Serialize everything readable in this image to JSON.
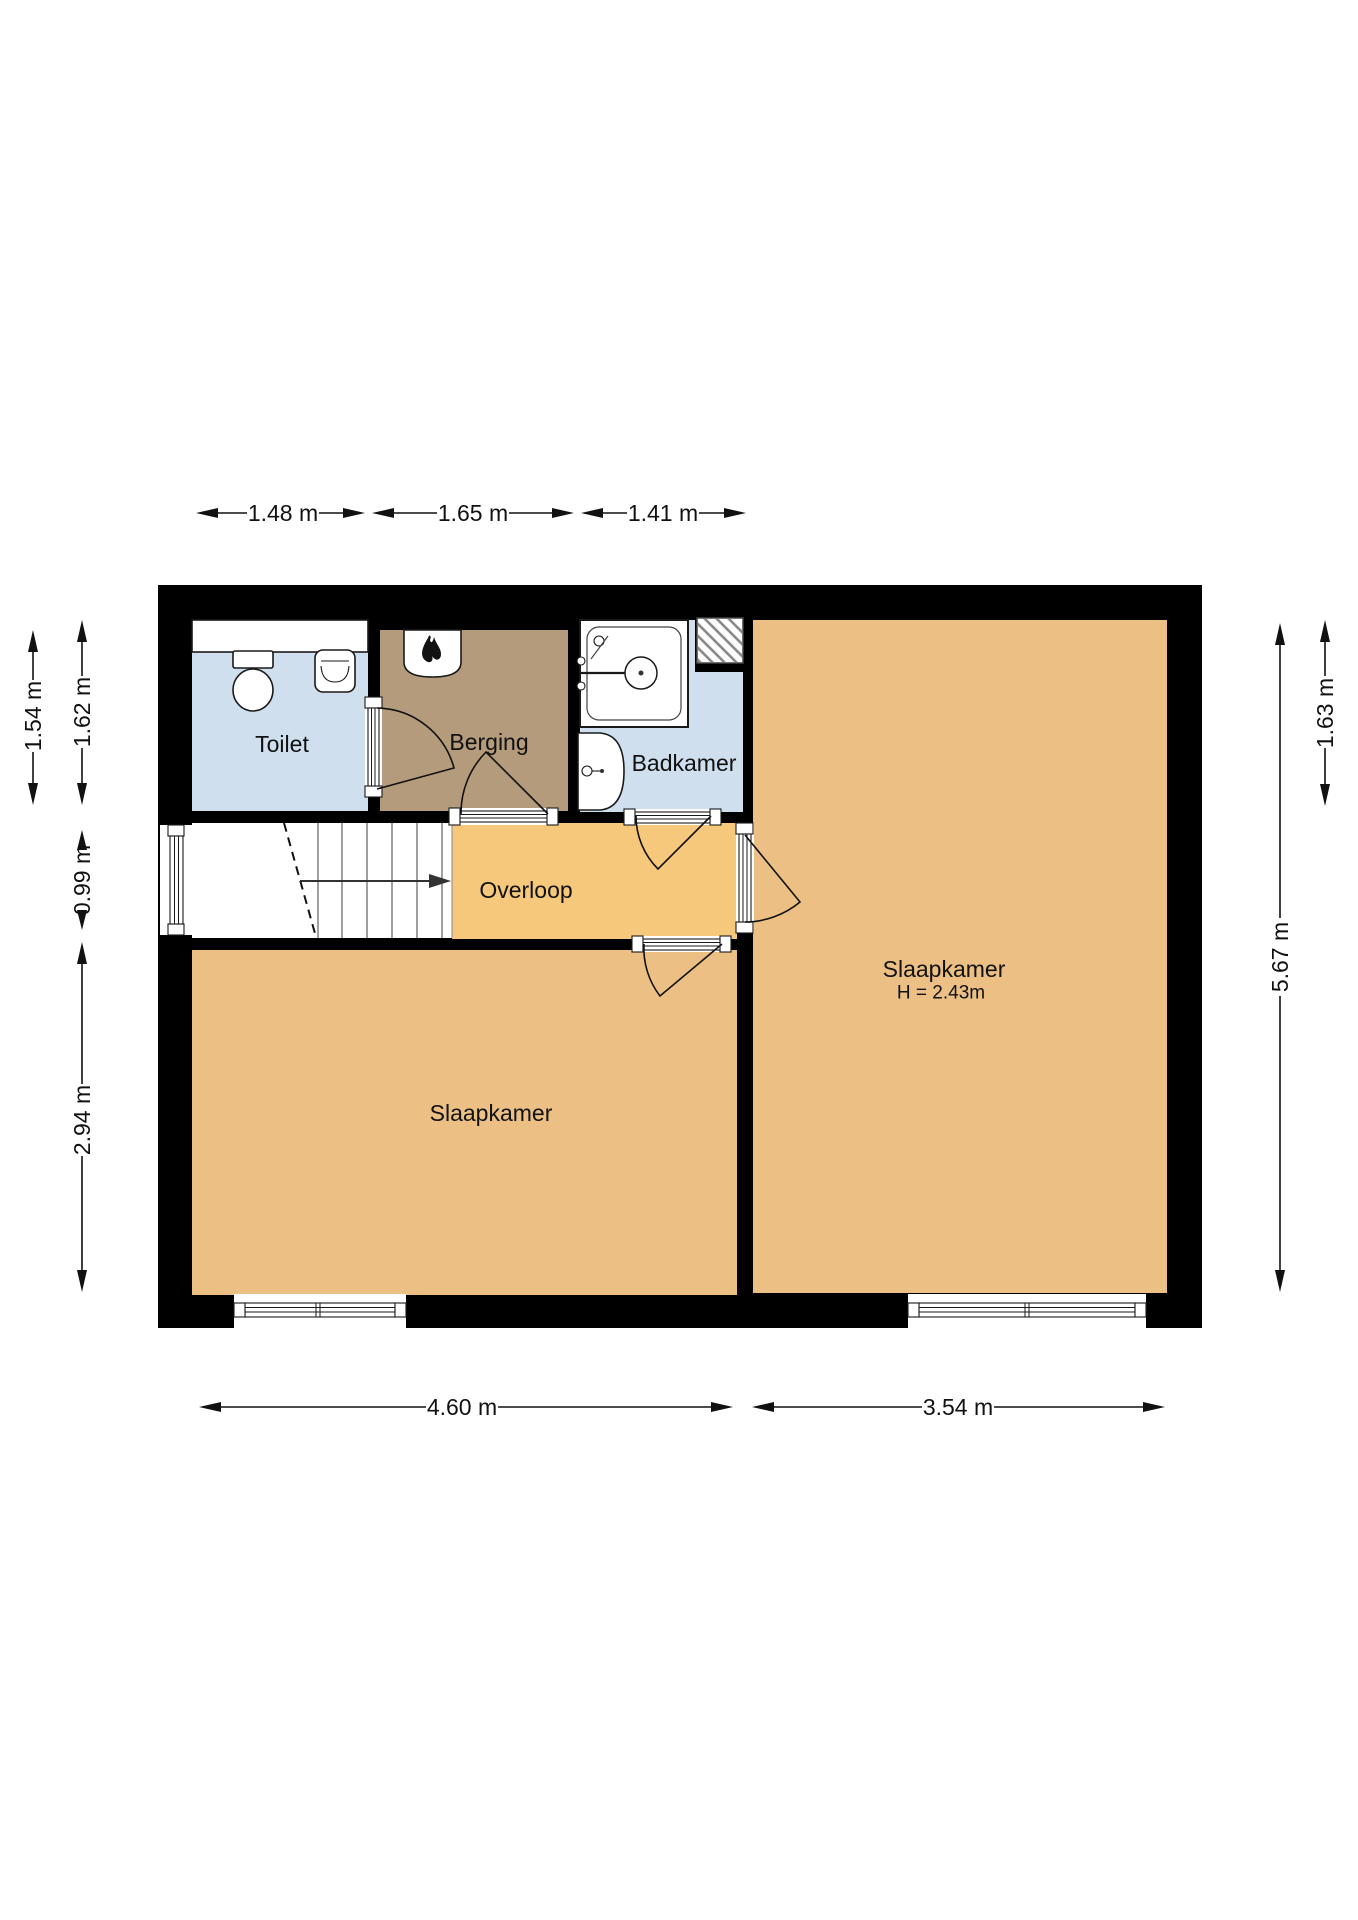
{
  "title": "Floor plan",
  "rooms": {
    "toilet": {
      "label": "Toilet"
    },
    "berging": {
      "label": "Berging"
    },
    "badkamer": {
      "label": "Badkamer"
    },
    "overloop": {
      "label": "Overloop"
    },
    "slaapkamer_left": {
      "label": "Slaapkamer"
    },
    "slaapkamer_right": {
      "label": "Slaapkamer",
      "height_note": "H = 2.43m"
    }
  },
  "dimensions": {
    "top": {
      "toilet": "1.48 m",
      "berging": "1.65 m",
      "badkamer": "1.41 m"
    },
    "left": {
      "berging_depth": "1.54 m",
      "toilet_depth": "1.62 m",
      "stairs": "0.99 m",
      "slaapkamer": "2.94 m"
    },
    "right": {
      "badkamer_depth": "1.63 m",
      "slaapkamer": "5.67 m"
    },
    "bottom": {
      "left_section": "4.60 m",
      "right_section": "3.54 m"
    }
  },
  "icons": {
    "boiler": "flame-icon",
    "shower": "shower-head-icon",
    "toilet": "toilet-bowl-icon",
    "sinks": "washbasin-icon",
    "stairs": "stairs-up-arrow-icon",
    "shaft": "diagonal-hatch-shaft"
  },
  "colors": {
    "wall": "#000000",
    "toilet": "#cfdfee",
    "badkamer": "#cfdfee",
    "berging": "#b39b7c",
    "overloop": "#f6c87c",
    "slaapkamer": "#ecc084",
    "stairs": "#ffffff"
  }
}
